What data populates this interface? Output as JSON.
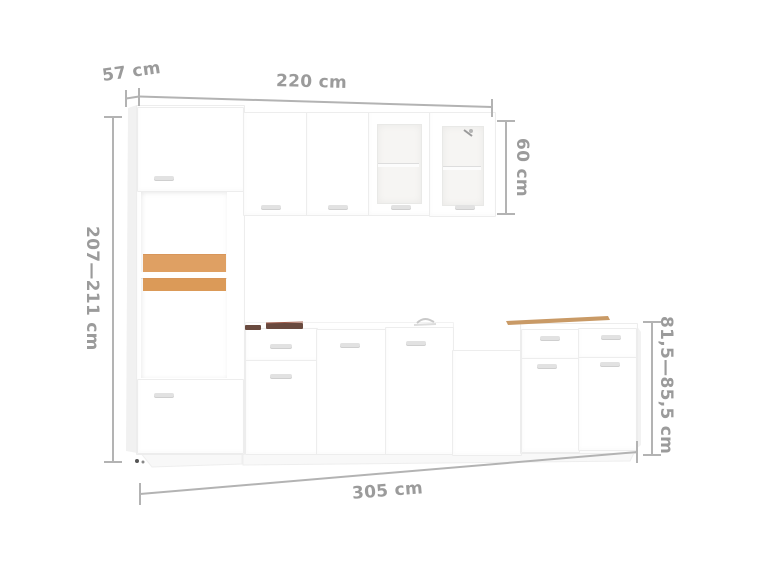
{
  "image": {
    "description": "Product dimension diagram of a white 7-piece kitchen cabinet set with wall units, glass doors, tall microwave cabinet and base units",
    "background": "#ffffff"
  },
  "dimensions": {
    "depth": "57 cm",
    "upper_width": "220 cm",
    "upper_height": "60 cm",
    "total_height": "207—211 cm",
    "base_height": "81,5—85,5 cm",
    "total_width": "305 cm"
  },
  "colors": {
    "dimension_line": "#b3b3b3",
    "dimension_text": "#9b9b9b",
    "cabinet_edge": "#ededed",
    "wood_shelf": "#dfa063",
    "countertop_trim": "#c99a66",
    "hob_dark": "#6a4a3f"
  }
}
